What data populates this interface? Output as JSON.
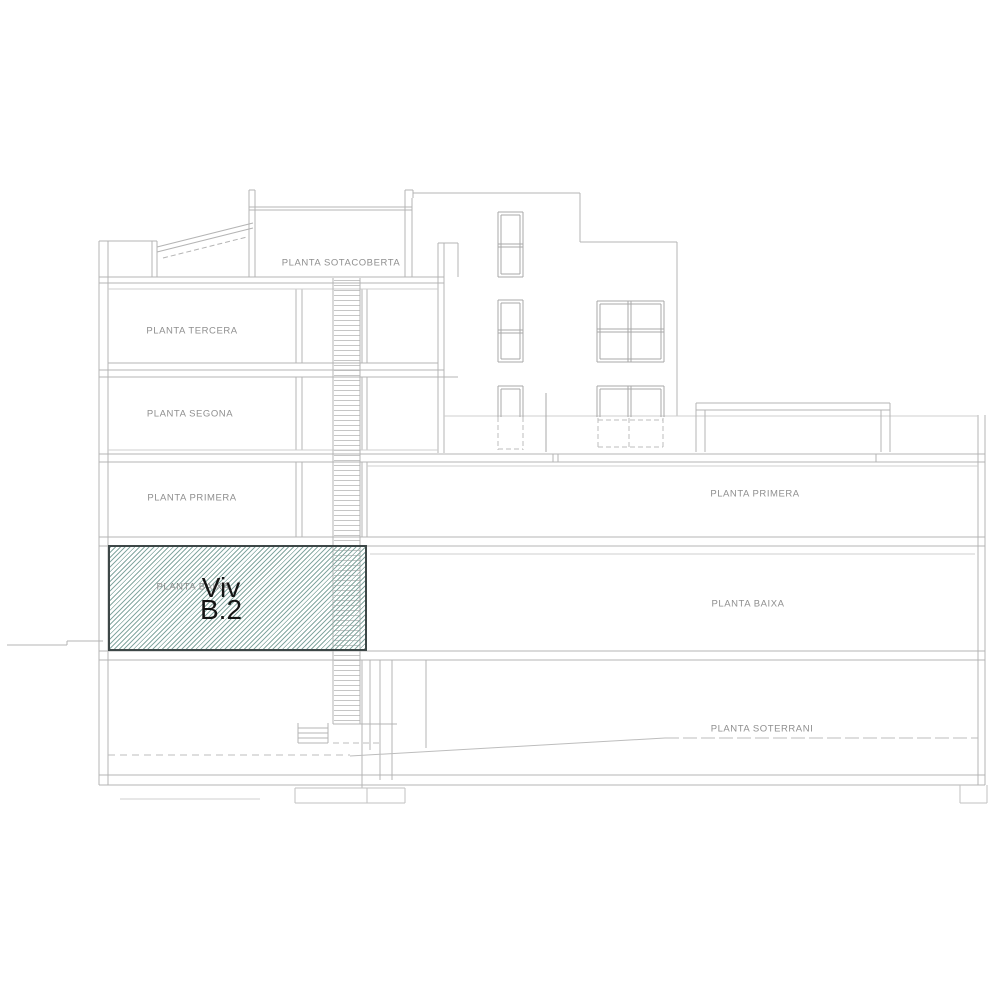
{
  "drawing": {
    "type": "architectural-building-section",
    "labels": {
      "sotacoberta": "PLANTA SOTACOBERTA",
      "tercera": "PLANTA TERCERA",
      "segona": "PLANTA SEGONA",
      "primera_left": "PLANTA PRIMERA",
      "primera_right": "PLANTA PRIMERA",
      "baixa_left": "PLANTA BAIXA",
      "baixa_right": "PLANTA BAIXA",
      "soterrani": "PLANTA SOTERRANI"
    },
    "highlighted_unit": {
      "name_line1": "Viv",
      "name_line2": "B.2",
      "hatch_color": "#85a8a2",
      "border_color": "#3d4747",
      "text_color": "#141414"
    },
    "colors": {
      "line": "#b4b4b4",
      "line_light": "#cfcfcf",
      "window_line": "#a8a8a8",
      "label_text": "#8f8f8f",
      "background": "#ffffff"
    }
  }
}
